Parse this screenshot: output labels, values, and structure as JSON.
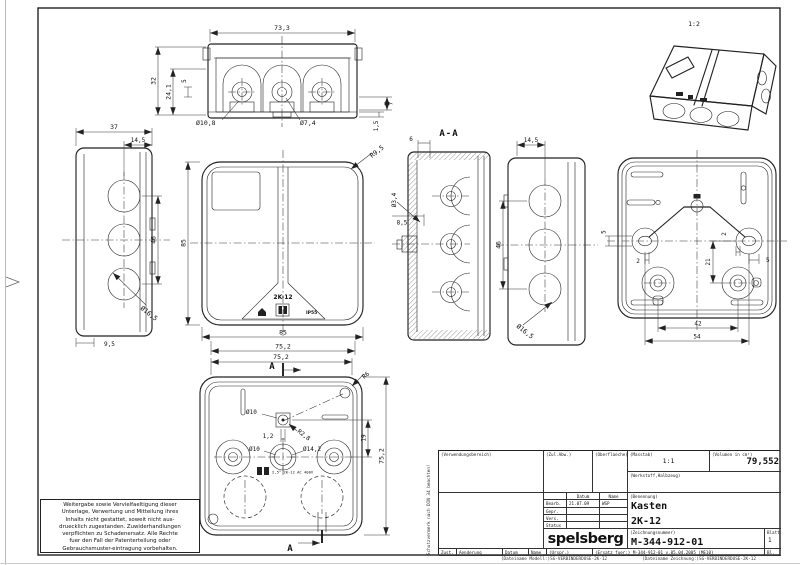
{
  "labels": {
    "iso_scale": "1:2",
    "section_title": "A-A",
    "section_arrow": "A",
    "front_product": "2K-12",
    "front_ip": "IP55",
    "bottom_print": "2,5² 2K-12 AC 400V"
  },
  "dims": {
    "top_width": "73,3",
    "top_h1": "32",
    "top_h2": "24,1",
    "top_h3": "5",
    "top_r1": "7",
    "top_r2": "1,5",
    "top_d1": "Ø10,8",
    "top_d2": "Ø7,4",
    "left_w": "37",
    "left_w2": "14,5",
    "left_h": "46",
    "left_d": "Ø16,5",
    "left_off": "9,5",
    "front_h": "85",
    "front_w": "85",
    "front_w2": "75,2",
    "front_r": "R9,5",
    "sec_t": "6",
    "sec_d": "Ø3,4",
    "sec_o": "8,5",
    "right_w": "14,5",
    "right_h": "46",
    "right_d": "Ø16,5",
    "back_o1": "5",
    "back_o2": "2",
    "back_o3": "2",
    "back_v": "21",
    "back_o4": "5",
    "back_b1": "42",
    "back_b2": "54",
    "bot_w": "75,2",
    "bot_r1": "R6",
    "bot_d1": "Ø10",
    "bot_r2": "R2,8",
    "bot_o1": "1,2",
    "bot_d2": "Ø10",
    "bot_d3": "Ø14,2",
    "bot_v1": "19",
    "bot_h": "75,2"
  },
  "note": {
    "lines": [
      "Weitergabe sowie Vervielfaeltigung dieser",
      "Unterlage, Verwertung und Mitteilung ihres",
      "Inhalts nicht gestattet, soweit nicht aus-",
      "druecklich zugestanden. Zuwiderhandlungen",
      "verpflichten zu Schadenersatz. Alle Rechte",
      "fuer den Fall der Patenterteilung oder",
      "Gebrauchsmuster-eintragung vorbehalten."
    ]
  },
  "protect_note": "Schutzvermerk nach DIN 34 beachten!",
  "titleblock": {
    "verwendungsbereich_label": "(Verwendungsbereich)",
    "zul_abw_label": "(Zul.Abw.)",
    "oberflaeche_label": "(Oberflaeche)",
    "masstab_label": "(Masstab)",
    "masstab_value": "1:1",
    "volumen_label": "(Volumen in cm³)",
    "volumen_value": "79,552",
    "werkstoff_label": "(Werkstoff,Halbzeug)",
    "datum_label": "Datum",
    "name_label": "Name",
    "bearb_label": "Bearb.",
    "bearb_datum": "21.07.09",
    "bearb_name": "WSP",
    "gepr_label": "Gepr.",
    "vers_label": "Vers.",
    "status_label": "Status",
    "benennung_label": "(Benennung)",
    "benennung_line1": "Kasten",
    "benennung_line2": "2K-12",
    "logo": "spelsberg",
    "zeichnungsnummer_label": "(Zeichnungsnummer)",
    "zeichnungsnummer": "M-344-912-01",
    "blatt_label": "Blatt",
    "blatt_value": "1",
    "bl_label": "Bl.",
    "zust_label": "Zust.",
    "aenderung_label": "Aenderung",
    "datum2_label": "Datum",
    "name2_label": "Name",
    "urspr_label": "(Urspr.)",
    "ersatz_text": "(Ersatz fuer:) M-344-912-01 v.05.04.2005 (ME10)",
    "file_model": "(Dateiname Modell:)SG-VERBINDERDOSE-2K-12",
    "file_drawing": "(Dateiname Zeichnung:)SG-VERBINDERDOSE-2K-12"
  }
}
